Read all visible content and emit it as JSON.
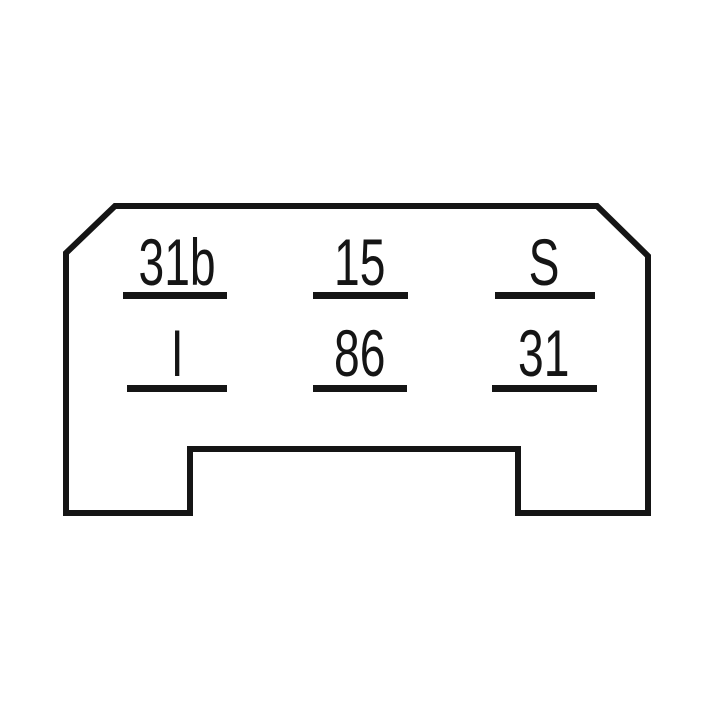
{
  "diagram": {
    "kind": "relay-pinout-diagram",
    "background_color": "#ffffff",
    "line_color": "#151515",
    "pins": [
      {
        "label": "31b",
        "row": 1,
        "col": 1
      },
      {
        "label": "15",
        "row": 1,
        "col": 2
      },
      {
        "label": "S",
        "row": 1,
        "col": 3
      },
      {
        "label": "I",
        "row": 2,
        "col": 1
      },
      {
        "label": "86",
        "row": 2,
        "col": 2
      },
      {
        "label": "31",
        "row": 2,
        "col": 3
      }
    ]
  }
}
